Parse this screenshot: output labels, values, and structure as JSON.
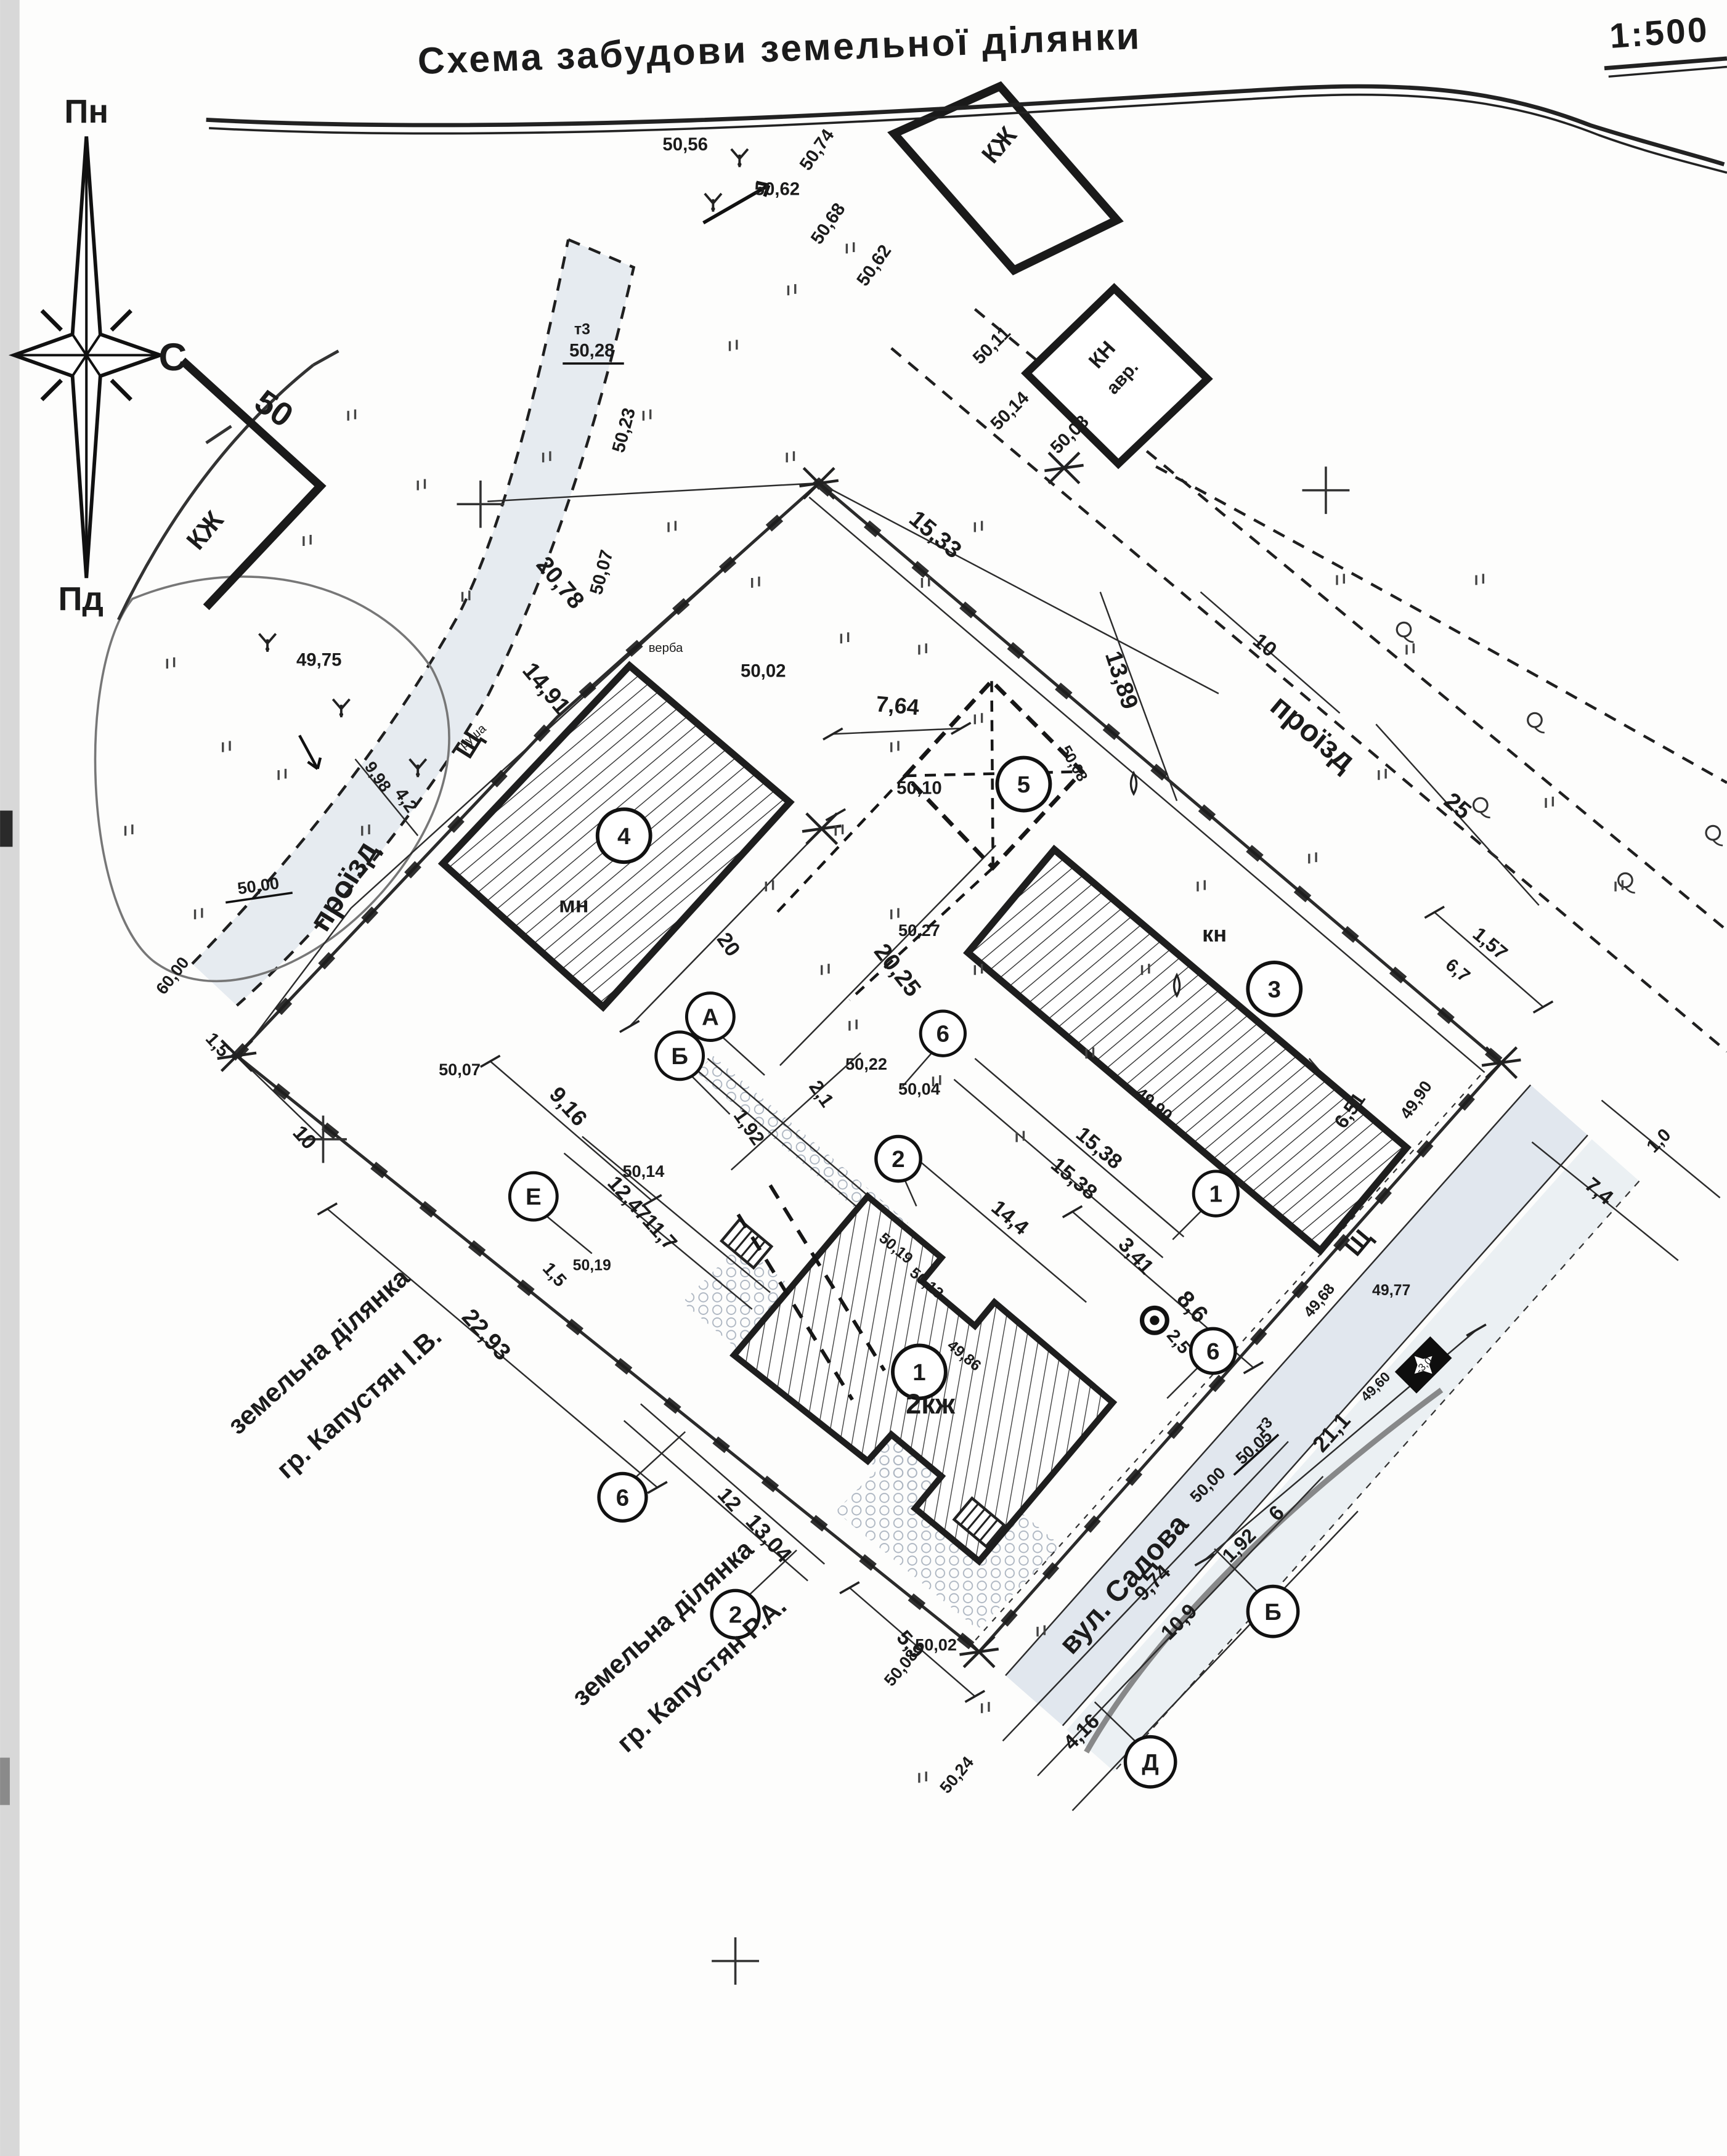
{
  "title": {
    "text": "Схема забудови земельної ділянки",
    "scale": "1:500"
  },
  "compass": {
    "north": "Пн",
    "south": "Пд",
    "corner": "С"
  },
  "buildings": {
    "left_kzh": "КЖ",
    "top_kzh": "КЖ",
    "kn_top": "КН",
    "kn_top_note": "авр.",
    "b4_label": "мн",
    "b3_label": "кн",
    "b1_label": "2кж"
  },
  "areas": {
    "driveway_left": "проїзд",
    "driveway_right": "проїзд",
    "street": "вул. Садова",
    "gravel_left": "Щ",
    "gravel_right": "Щ",
    "contour": "50",
    "willow": "верба",
    "pear": "груша",
    "parcel_side_line1": "земельна ділянка",
    "parcel_side_line2": "гр. Капустян І.В.",
    "parcel_bottom_line1": "земельна ділянка",
    "parcel_bottom_line2": "гр. Капустян Р.А."
  },
  "points": {
    "n4": "4",
    "n5": "5",
    "n3": "3",
    "n1_bld": "1",
    "n2": "2",
    "n6a": "6",
    "n1": "1",
    "n6b": "6",
    "n6c": "6",
    "n2b": "2",
    "pA": "А",
    "pB": "Б",
    "pE": "Е",
    "pB2": "Б",
    "pD": "Д",
    "well_mark": "2,5"
  },
  "benchmarks": {
    "t3_top_name": "т3",
    "t3_top_val": "50,28",
    "t3_bot_name": "т3",
    "t3_bot_val": "50,05",
    "bm_val": "50,00",
    "monument_val": "-3,0"
  },
  "dims": [
    "20,78",
    "14,91",
    "9,98",
    "4,2",
    "15,33",
    "13,89",
    "10",
    "25",
    "7,64",
    "20",
    "20,25",
    "2,1",
    "1,92",
    "9,16",
    "12,47",
    "11,7",
    "1,5",
    "1,5",
    "10",
    "22,93",
    "12",
    "13,04",
    "5,9",
    "15,38",
    "15,38",
    "14,4",
    "3,41",
    "8,6",
    "6,51",
    "1,57",
    "6,7",
    "7,4",
    "1,0",
    "21,1",
    "6",
    "1,92",
    "9,74",
    "10,9",
    "4,16"
  ],
  "elevations": [
    "50,56",
    "50,62",
    "50,74",
    "50,68",
    "50,62",
    "50,11",
    "50,14",
    "50,08",
    "50,23",
    "50,07",
    "50,02",
    "50,10",
    "50,27",
    "50,22",
    "50,14",
    "50,07",
    "60,00",
    "49,75",
    "50,19",
    "50,19",
    "50,13",
    "49,86",
    "50,04",
    "49,90",
    "49,90",
    "50,08",
    "49,68",
    "49,77",
    "49,60",
    "50,00",
    "50,08",
    "50,24",
    "50,02"
  ]
}
